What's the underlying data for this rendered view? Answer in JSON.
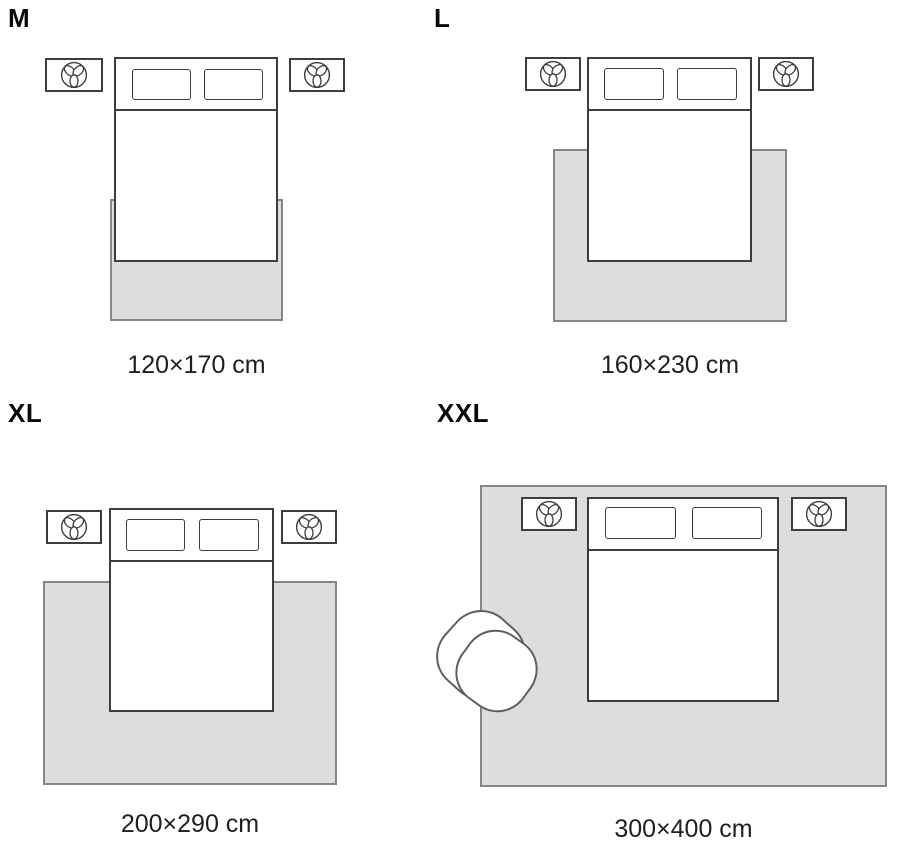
{
  "colors": {
    "background": "#ffffff",
    "rug_fill": "#dddddd",
    "rug_border": "#868686",
    "line": "#3d3d3d",
    "chair_line": "#5f5f5f",
    "text_strong": "#0a0a0a",
    "text_dim": "#1f1f1f"
  },
  "icons": {
    "nightstand": "trefoil-plant-icon"
  },
  "panels": [
    {
      "size_label": "M",
      "dimension_label": "120×170 cm",
      "furniture": [
        "bed",
        "pillow-left",
        "pillow-right",
        "nightstand-left",
        "nightstand-right",
        "rug"
      ]
    },
    {
      "size_label": "L",
      "dimension_label": "160×230 cm",
      "furniture": [
        "bed",
        "pillow-left",
        "pillow-right",
        "nightstand-left",
        "nightstand-right",
        "rug"
      ]
    },
    {
      "size_label": "XL",
      "dimension_label": "200×290 cm",
      "furniture": [
        "bed",
        "pillow-left",
        "pillow-right",
        "nightstand-left",
        "nightstand-right",
        "rug"
      ]
    },
    {
      "size_label": "XXL",
      "dimension_label": "300×400 cm",
      "furniture": [
        "bed",
        "pillow-left",
        "pillow-right",
        "nightstand-left",
        "nightstand-right",
        "rug",
        "armchair"
      ]
    }
  ]
}
